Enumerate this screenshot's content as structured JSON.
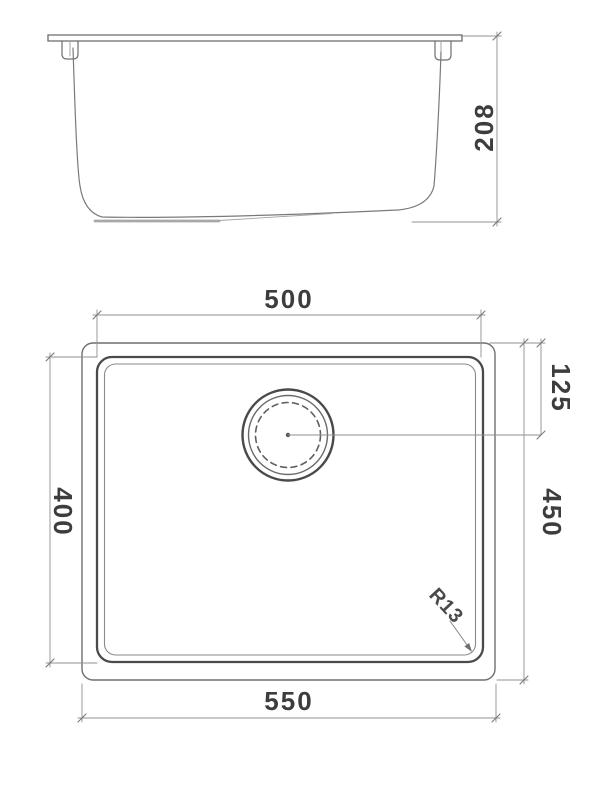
{
  "drawing": {
    "background": "#ffffff",
    "object_line_color": "#5a5a5a",
    "dimension_line_color": "#8f8f8f",
    "text_color": "#3d3d3d",
    "side_view": {
      "height_label": "208"
    },
    "plan_view": {
      "bowl_width_label": "500",
      "drain_offset_label": "125",
      "bowl_depth_label": "400",
      "overall_depth_label": "450",
      "overall_width_label": "550",
      "corner_radius_label": "R13"
    }
  }
}
